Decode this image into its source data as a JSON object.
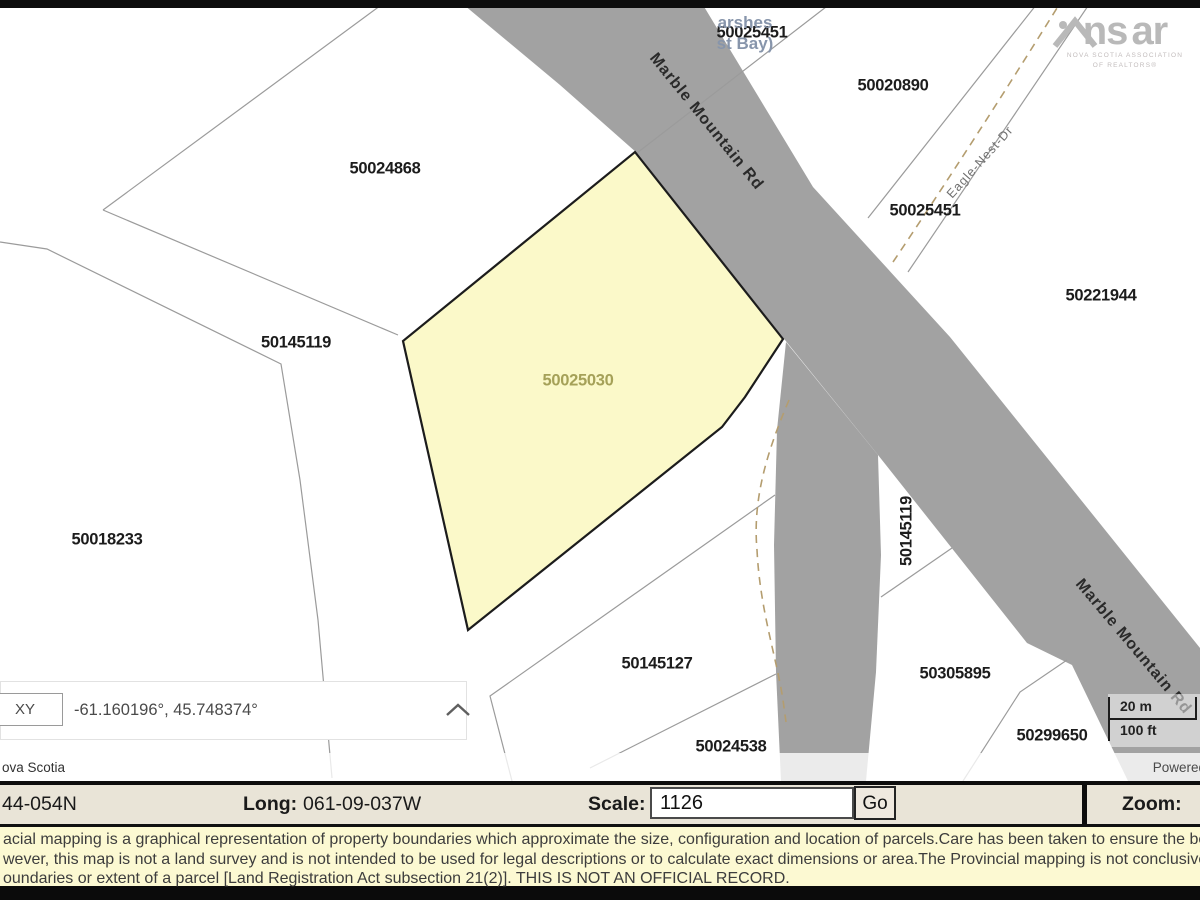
{
  "map": {
    "place_name": {
      "line1": "arshes",
      "line2": "st Bay)"
    },
    "parcels": [
      {
        "id": "50025451",
        "x": 752,
        "y": 33
      },
      {
        "id": "50020890",
        "x": 893,
        "y": 86
      },
      {
        "id": "50024868",
        "x": 385,
        "y": 169
      },
      {
        "id": "50025451",
        "x": 925,
        "y": 211
      },
      {
        "id": "50221944",
        "x": 1101,
        "y": 296
      },
      {
        "id": "50145119",
        "x": 296,
        "y": 343
      },
      {
        "id": "50025030",
        "x": 578,
        "y": 381,
        "color": "#a5a158"
      },
      {
        "id": "50018233",
        "x": 107,
        "y": 540
      },
      {
        "id": "50145119",
        "x": 907,
        "y": 531,
        "rot": -90
      },
      {
        "id": "50145127",
        "x": 657,
        "y": 664
      },
      {
        "id": "50305895",
        "x": 955,
        "y": 674
      },
      {
        "id": "50024538",
        "x": 731,
        "y": 747
      },
      {
        "id": "50299650",
        "x": 1052,
        "y": 736
      }
    ],
    "road_labels": [
      {
        "name": "Marble Mountain Rd",
        "x": 706,
        "y": 122,
        "rot": 51,
        "small": false
      },
      {
        "name": "Marble Mountain Rd",
        "x": 1133,
        "y": 647,
        "rot": 50,
        "small": false
      },
      {
        "name": "Eagle-Nest-Dr",
        "x": 980,
        "y": 162,
        "rot": -48,
        "small": true
      }
    ],
    "highlighted_parcel": "50025030",
    "scale_bar": {
      "metric": "20 m",
      "imperial": "100 ft"
    },
    "attribution_left": "ova Scotia",
    "attribution_right": "Powered",
    "coordinate_widget": {
      "mode": "XY",
      "value": "-61.160196°, 45.748374°"
    }
  },
  "logo": {
    "ns": "ns",
    "ar": "ar",
    "sub1": "NOVA SCOTIA ASSOCIATION",
    "sub2": "OF REALTORS®"
  },
  "statusbar": {
    "lat_value": "44-054N",
    "long_label": "Long:",
    "long_value": "061-09-037W",
    "scale_label": "Scale:",
    "scale_value": "1126",
    "go_label": "Go",
    "zoom_label": "Zoom:"
  },
  "disclaimer": {
    "line1": "acial mapping is a graphical representation of property boundaries which approximate the size, configuration and location of parcels.Care has been taken to ensure the best po",
    "line2": "wever, this map is not a land survey and is not intended to be used for legal descriptions or to calculate exact dimensions or area.The Provincial mapping is not conclusive as t",
    "line3": "oundaries or extent of a parcel [Land Registration Act subsection 21(2)]. THIS IS NOT AN OFFICIAL RECORD."
  },
  "colors": {
    "road": "#a2a2a2",
    "highlight_fill": "#fbf9c9",
    "highlight_label": "#a5a158",
    "dashed_road": "#b49d6f",
    "statusbar_bg": "#e9e4d7",
    "disclaimer_bg": "#fcf9d2"
  }
}
